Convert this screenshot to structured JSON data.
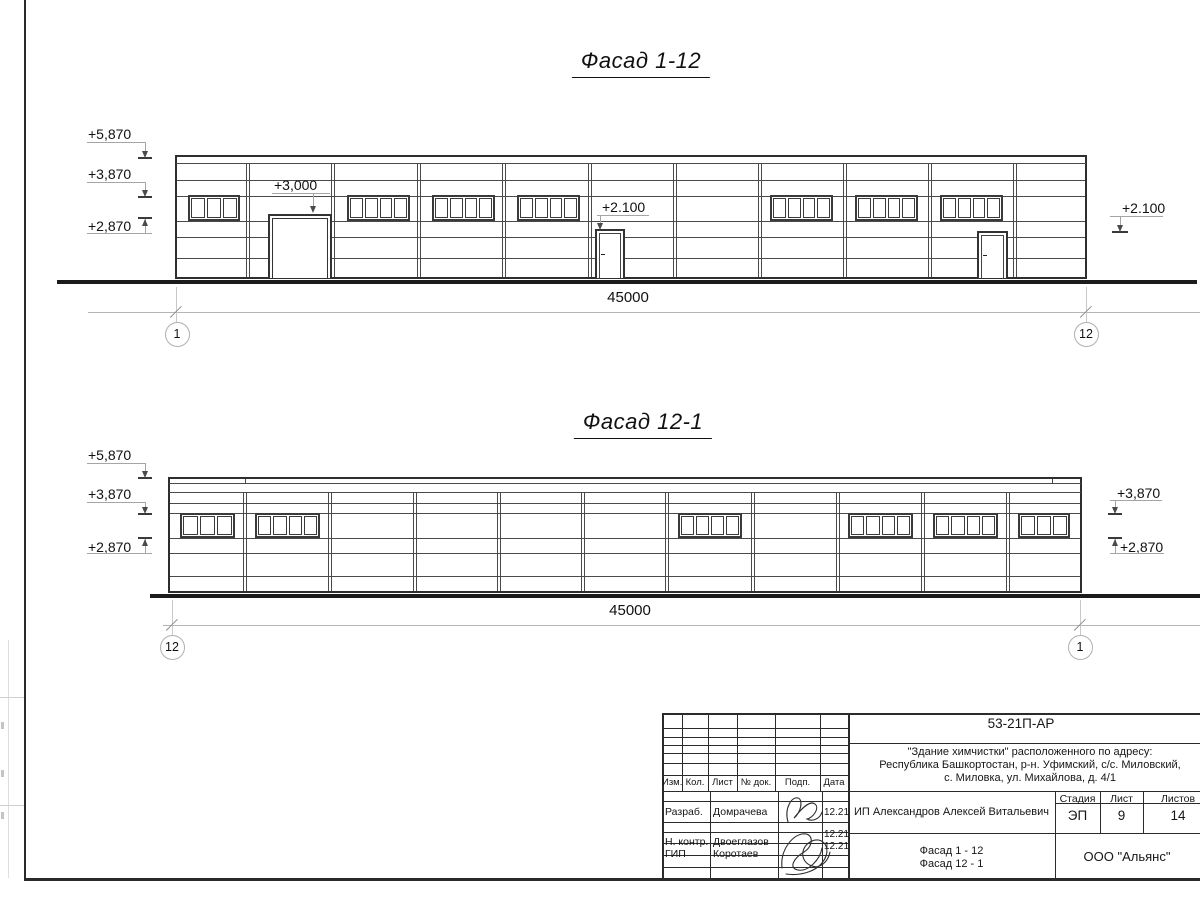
{
  "facades": [
    {
      "id": "facade-1-12",
      "title": "Фасад 1-12",
      "title_x": 641,
      "title_y": 48,
      "geom": {
        "left": 175,
        "right": 1087,
        "top": 155,
        "base": 277,
        "col_top": 163,
        "band_lines": [
          163
        ],
        "h_lines": [
          180,
          196,
          221,
          237,
          258
        ],
        "columns": [
          248,
          333,
          419,
          504,
          590,
          675,
          760,
          845,
          930,
          1015
        ]
      },
      "window_band": {
        "top": 195,
        "h": 26
      },
      "windows": [
        {
          "x": 188,
          "w": 52,
          "panes": 3
        },
        {
          "x": 347,
          "w": 63,
          "panes": 4
        },
        {
          "x": 432,
          "w": 63,
          "panes": 4
        },
        {
          "x": 517,
          "w": 63,
          "panes": 4
        },
        {
          "x": 770,
          "w": 63,
          "panes": 4
        },
        {
          "x": 855,
          "w": 63,
          "panes": 4
        },
        {
          "x": 940,
          "w": 63,
          "panes": 4
        }
      ],
      "gate": {
        "x": 268,
        "w": 64,
        "top": 214
      },
      "doors": [
        {
          "x": 595,
          "w": 30,
          "top": 229
        },
        {
          "x": 977,
          "w": 31,
          "top": 231
        }
      ],
      "joints": [],
      "ground": {
        "x1": 57,
        "x2": 1197,
        "y": 280,
        "h": 4
      },
      "marks": [
        {
          "text": "+5,870",
          "tx": 88,
          "ty": 126,
          "ul": [
            87,
            145,
            142
          ],
          "shaft": [
            145,
            142,
            152
          ],
          "arrow": "down",
          "tick": [
            138,
            152,
            157
          ]
        },
        {
          "text": "+3,870",
          "tx": 88,
          "ty": 166,
          "ul": [
            87,
            145,
            182
          ],
          "shaft": [
            145,
            182,
            191
          ],
          "arrow": "down",
          "tick": [
            138,
            152,
            196
          ]
        },
        {
          "text": "+2,870",
          "tx": 88,
          "ty": 218,
          "ul": [
            87,
            152,
            233
          ],
          "shaft": [
            145,
            219,
            233
          ],
          "arrow": "up",
          "tick": [
            138,
            152,
            217
          ]
        },
        {
          "text": "+3,000",
          "tx": 274,
          "ty": 177,
          "ul": [
            272,
            330,
            193
          ],
          "shaft": [
            313,
            193,
            207
          ],
          "arrow": "down",
          "tick": null
        },
        {
          "text": "+2.100",
          "tx": 602,
          "ty": 199,
          "ul": [
            597,
            649,
            215
          ],
          "shaft": [
            600,
            215,
            224
          ],
          "arrow": "down",
          "tick": null
        },
        {
          "text": "+2.100",
          "tx": 1122,
          "ty": 200,
          "ul": [
            1110,
            1163,
            216
          ],
          "shaft": [
            1120,
            216,
            226
          ],
          "arrow": "down",
          "tick": [
            1112,
            1128,
            231
          ]
        }
      ],
      "dim": {
        "text": "45000",
        "y": 312,
        "x1": 88,
        "x2": 1200,
        "text_x": 628,
        "text_y": 289,
        "ext": [
          {
            "x": 176,
            "y1": 287,
            "y2": 325
          },
          {
            "x": 1086,
            "y1": 287,
            "y2": 325
          }
        ],
        "axes": [
          {
            "label": "1",
            "cx": 177,
            "cy": 334
          },
          {
            "label": "12",
            "cx": 1086,
            "cy": 334
          }
        ]
      }
    },
    {
      "id": "facade-12-1",
      "title": "Фасад 12-1",
      "title_x": 643,
      "title_y": 409,
      "geom": {
        "left": 168,
        "right": 1082,
        "top": 477,
        "base": 591,
        "col_top": 492,
        "band_lines": [
          483,
          492
        ],
        "h_lines": [
          503,
          513,
          538,
          553,
          576
        ],
        "columns": [
          245,
          330,
          415,
          499,
          583,
          667,
          753,
          838,
          923,
          1008
        ]
      },
      "window_band": {
        "top": 513,
        "h": 25
      },
      "windows": [
        {
          "x": 180,
          "w": 55,
          "panes": 3
        },
        {
          "x": 255,
          "w": 65,
          "panes": 4
        },
        {
          "x": 678,
          "w": 64,
          "panes": 4
        },
        {
          "x": 848,
          "w": 65,
          "panes": 4
        },
        {
          "x": 933,
          "w": 65,
          "panes": 4
        },
        {
          "x": 1018,
          "w": 52,
          "panes": 3
        }
      ],
      "gate": null,
      "doors": [],
      "joints": [
        {
          "x": 245
        },
        {
          "x": 1052
        }
      ],
      "ground": {
        "x1": 150,
        "x2": 1200,
        "y": 594,
        "h": 4
      },
      "marks": [
        {
          "text": "+5,870",
          "tx": 88,
          "ty": 447,
          "ul": [
            87,
            145,
            463
          ],
          "shaft": [
            145,
            463,
            472
          ],
          "arrow": "down",
          "tick": [
            138,
            152,
            477
          ]
        },
        {
          "text": "+3,870",
          "tx": 88,
          "ty": 486,
          "ul": [
            87,
            145,
            502
          ],
          "shaft": [
            145,
            502,
            508
          ],
          "arrow": "down",
          "tick": [
            138,
            152,
            513
          ]
        },
        {
          "text": "+2,870",
          "tx": 88,
          "ty": 539,
          "ul": [
            87,
            152,
            553
          ],
          "shaft": [
            145,
            539,
            553
          ],
          "arrow": "up",
          "tick": [
            138,
            152,
            537
          ]
        },
        {
          "text": "+3,870",
          "tx": 1117,
          "ty": 485,
          "ul": [
            1110,
            1162,
            500
          ],
          "shaft": [
            1115,
            500,
            508
          ],
          "arrow": "down",
          "tick": [
            1108,
            1122,
            513
          ]
        },
        {
          "text": "+2,870",
          "tx": 1120,
          "ty": 539,
          "ul": [
            1110,
            1164,
            553
          ],
          "shaft": [
            1115,
            539,
            553
          ],
          "arrow": "up",
          "tick": [
            1108,
            1122,
            537
          ]
        }
      ],
      "dim": {
        "text": "45000",
        "y": 625,
        "x1": 163,
        "x2": 1200,
        "text_x": 630,
        "text_y": 602,
        "ext": [
          {
            "x": 172,
            "y1": 600,
            "y2": 637
          },
          {
            "x": 1080,
            "y1": 600,
            "y2": 637
          }
        ],
        "axes": [
          {
            "label": "12",
            "cx": 172,
            "cy": 647
          },
          {
            "label": "1",
            "cx": 1080,
            "cy": 647
          }
        ]
      }
    }
  ],
  "titleblock": {
    "doc_number": "53-21П-АР",
    "project_lines": [
      "\"Здание химчистки\" расположенного по адресу:",
      "Республика Башкортостан, р-н. Уфимский, с/с. Миловский,",
      "с. Миловка, ул. Михайлова, д. 4/1"
    ],
    "header_cols": [
      "Изм.",
      "Кол.",
      "Лист",
      "№ док.",
      "Подп.",
      "Дата"
    ],
    "rows": [
      {
        "role": "Разраб.",
        "name": "Домрачева",
        "date": "12.21"
      },
      {
        "role": "Н. контр.",
        "name": "Двоеглазов",
        "date": "12.21"
      },
      {
        "role": "ГИП",
        "name": "Коротаев",
        "date": "12.21"
      }
    ],
    "client": "ИП Александров Алексей Витальевич",
    "stage_label": "Стадия",
    "sheet_label": "Лист",
    "sheets_label": "Листов",
    "stage": "ЭП",
    "sheet_no": "9",
    "sheets_total": "14",
    "drawing_title_lines": [
      "Фасад 1 - 12",
      "Фасад 12 - 1"
    ],
    "company": "ООО \"Альянс\""
  },
  "colors": {
    "line_dark": "#2e2e2e",
    "line_mid": "#4a4a4a",
    "ground": "#1b1b1b",
    "dim_gray": "#b5b5b5",
    "ext_gray": "#c8c8c8",
    "tick_gray": "#8f8f8f",
    "circle_gray": "#b0b0b0",
    "mark_line": "#a5a5a5",
    "mark_arrow": "#4a4a4a"
  }
}
